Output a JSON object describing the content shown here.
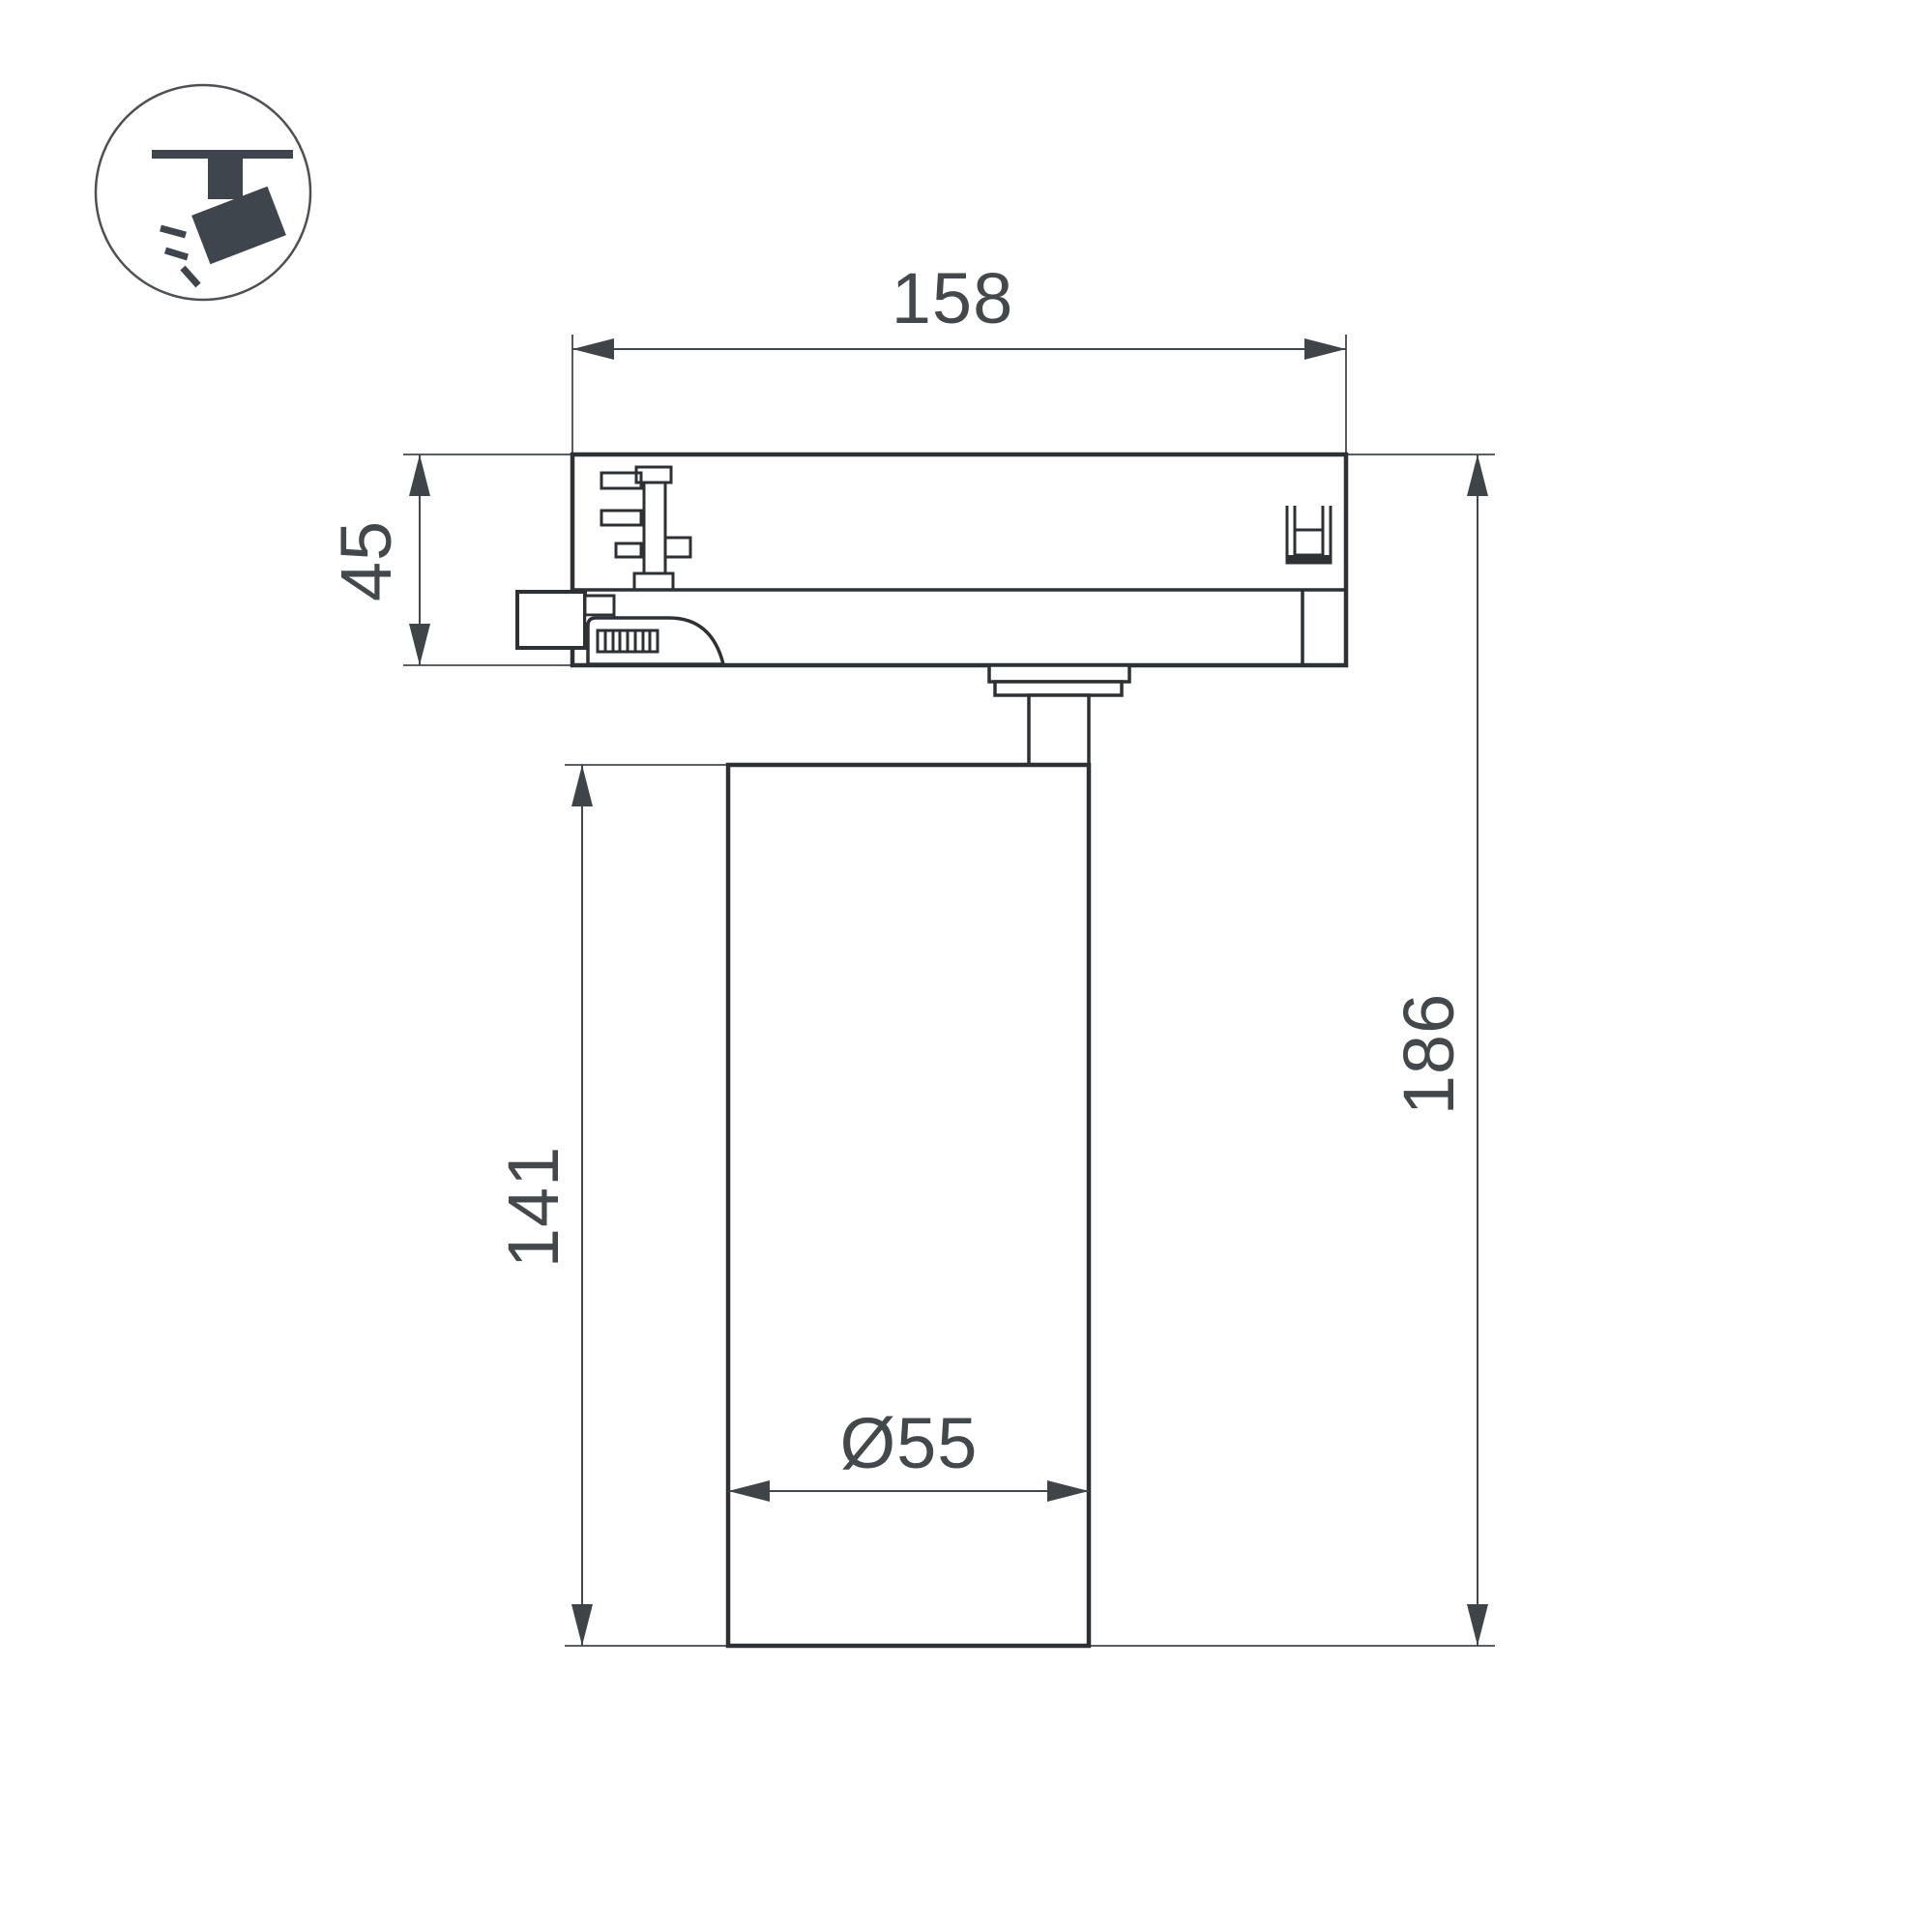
{
  "page": {
    "background": "#ffffff",
    "description": "Technical dimension drawing of a track-mounted LED spotlight, side view"
  },
  "icon": {
    "meaning": "spotlight hanging from ceiling track"
  },
  "drawing": {
    "colors": {
      "outline": "#2d3135",
      "dimension": "#43484d",
      "icon": "#3e454c",
      "background": "#ffffff"
    },
    "dimensions": {
      "adapter_width": "158",
      "adapter_height": "45",
      "body_height": "141",
      "total_height": "186",
      "body_diameter": "Ø55"
    }
  }
}
